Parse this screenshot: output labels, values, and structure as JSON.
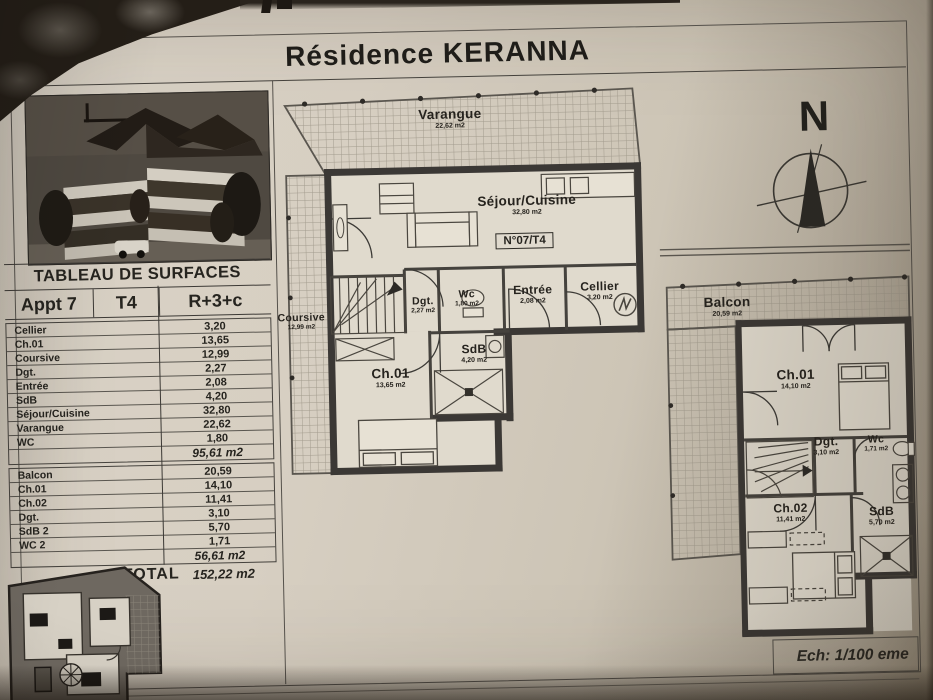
{
  "title": "Résidence KERANNA",
  "scale_label": "Ech: 1/100 eme",
  "compass": {
    "north_label": "N"
  },
  "surface_table": {
    "title": "TABLEAU DE SURFACES",
    "header_cols": [
      "Appt 7",
      "T4",
      "R+3+c"
    ],
    "level1_rows": [
      {
        "label": "Cellier",
        "value": "3,20"
      },
      {
        "label": "Ch.01",
        "value": "13,65"
      },
      {
        "label": "Coursive",
        "value": "12,99"
      },
      {
        "label": "Dgt.",
        "value": "2,27"
      },
      {
        "label": "Entrée",
        "value": "2,08"
      },
      {
        "label": "SdB",
        "value": "4,20"
      },
      {
        "label": "Séjour/Cuisine",
        "value": "32,80"
      },
      {
        "label": "Varangue",
        "value": "22,62"
      },
      {
        "label": "WC",
        "value": "1,80"
      }
    ],
    "level1_subtotal": "95,61 m2",
    "level2_rows": [
      {
        "label": "Balcon",
        "value": "20,59"
      },
      {
        "label": "Ch.01",
        "value": "14,10"
      },
      {
        "label": "Ch.02",
        "value": "11,41"
      },
      {
        "label": "Dgt.",
        "value": "3,10"
      },
      {
        "label": "SdB 2",
        "value": "5,70"
      },
      {
        "label": "WC 2",
        "value": "1,71"
      }
    ],
    "level2_subtotal": "56,61 m2",
    "total_label": "TOTAL",
    "total_value": "152,22 m2"
  },
  "main_plan": {
    "unit_label": "N°07/T4",
    "rooms": {
      "varangue": {
        "name": "Varangue",
        "area": "22,62 m2"
      },
      "sejour": {
        "name": "Séjour/Cuisine",
        "area": "32,80 m2"
      },
      "coursive": {
        "name": "Coursive",
        "area": "12,99 m2"
      },
      "dgt": {
        "name": "Dgt.",
        "area": "2,27 m2"
      },
      "wc": {
        "name": "Wc",
        "area": "1,80 m2"
      },
      "entree": {
        "name": "Entrée",
        "area": "2,08 m2"
      },
      "cellier": {
        "name": "Cellier",
        "area": "3,20 m2"
      },
      "ch01": {
        "name": "Ch.01",
        "area": "13,65 m2"
      },
      "sdb": {
        "name": "SdB",
        "area": "4,20 m2"
      }
    }
  },
  "upper_plan": {
    "rooms": {
      "balcon": {
        "name": "Balcon",
        "area": "20,59 m2"
      },
      "ch01": {
        "name": "Ch.01",
        "area": "14,10 m2"
      },
      "dgt": {
        "name": "Dgt.",
        "area": "3,10 m2"
      },
      "wc": {
        "name": "Wc",
        "area": "1,71 m2"
      },
      "ch02": {
        "name": "Ch.02",
        "area": "11,41 m2"
      },
      "sdb": {
        "name": "SdB",
        "area": "5,70 m2"
      }
    }
  },
  "colors": {
    "paper": "#d6cec0",
    "wall": "#3b3835",
    "ink": "#26231e"
  }
}
